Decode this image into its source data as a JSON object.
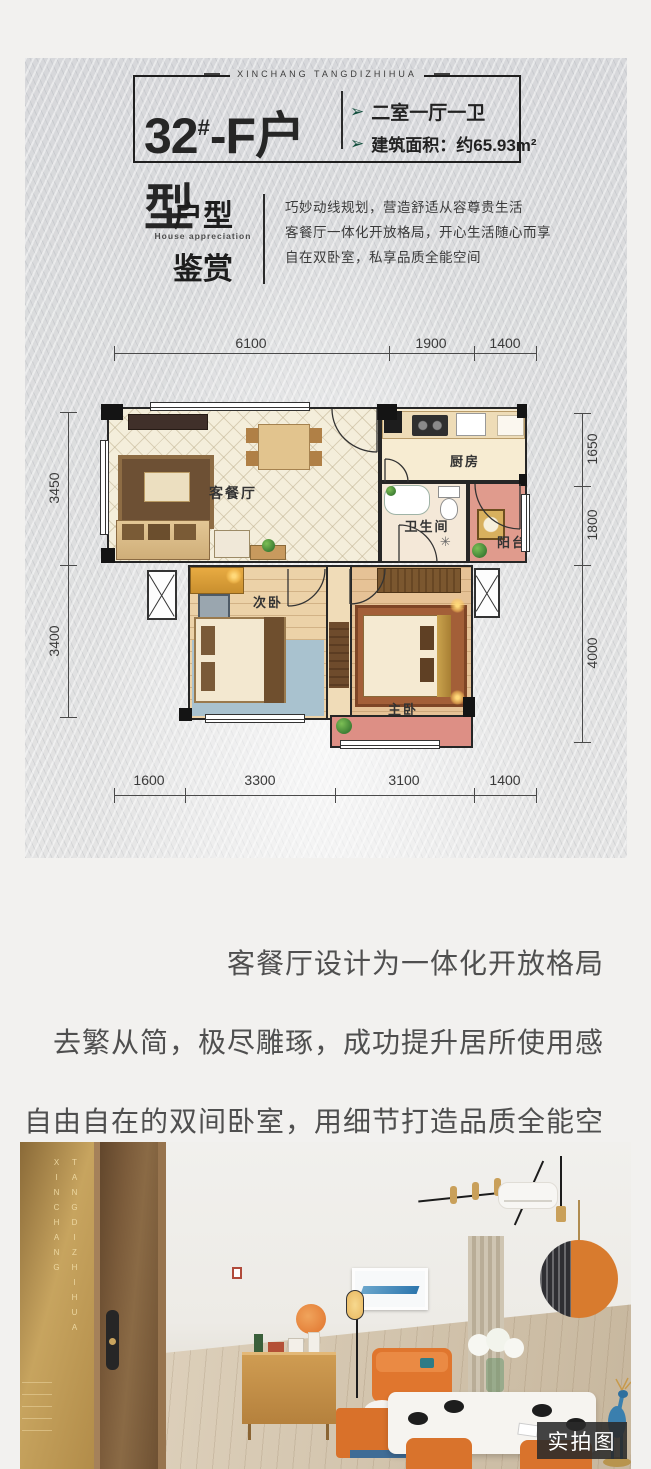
{
  "brand": {
    "name": "XINCHANG TANGDIZHIHUA"
  },
  "header": {
    "unit_number": "32",
    "unit_sup": "#",
    "unit_name": "-F户型",
    "features": [
      {
        "text": "二室一厅一卫"
      },
      {
        "text": "建筑面积：约65.93m²"
      }
    ]
  },
  "appreciation": {
    "title_line1": "户型",
    "title_en": "House appreciation",
    "title_line2": "鉴赏",
    "desc_lines": [
      "巧妙动线规划，营造舒适从容尊贵生活",
      "客餐厅一体化开放格局，开心生活随心而享",
      "自在双卧室，私享品质全能空间"
    ]
  },
  "floorplan": {
    "rooms": {
      "living": "客餐厅",
      "kitchen": "厨房",
      "bath": "卫生间",
      "balcony": "阳台",
      "bedroom2": "次卧",
      "master": "主卧"
    },
    "dims": {
      "top": [
        "6100",
        "1900",
        "1400"
      ],
      "bottom": [
        "1600",
        "3300",
        "3100",
        "1400"
      ],
      "left": [
        "3450",
        "3400"
      ],
      "right": [
        "1650",
        "1800",
        "4000"
      ]
    }
  },
  "tagline": {
    "lines": [
      "客餐厅设计为一体化开放格局",
      "去繁从简，极尽雕琢，成功提升居所使用感",
      "自由自在的双间卧室，用细节打造品质全能空间"
    ]
  },
  "photo": {
    "brand_col1": "XINCHANG",
    "brand_col2": "TANGDIZHIHUA",
    "badge": "实拍图"
  },
  "icons": {
    "feature_arrow": "➢",
    "shower": "✳"
  },
  "colors": {
    "accent_green": "#134f3e",
    "balcony_pink": "#e09b8d",
    "gold_band": "#bd9350",
    "orange": "#d9732c"
  }
}
